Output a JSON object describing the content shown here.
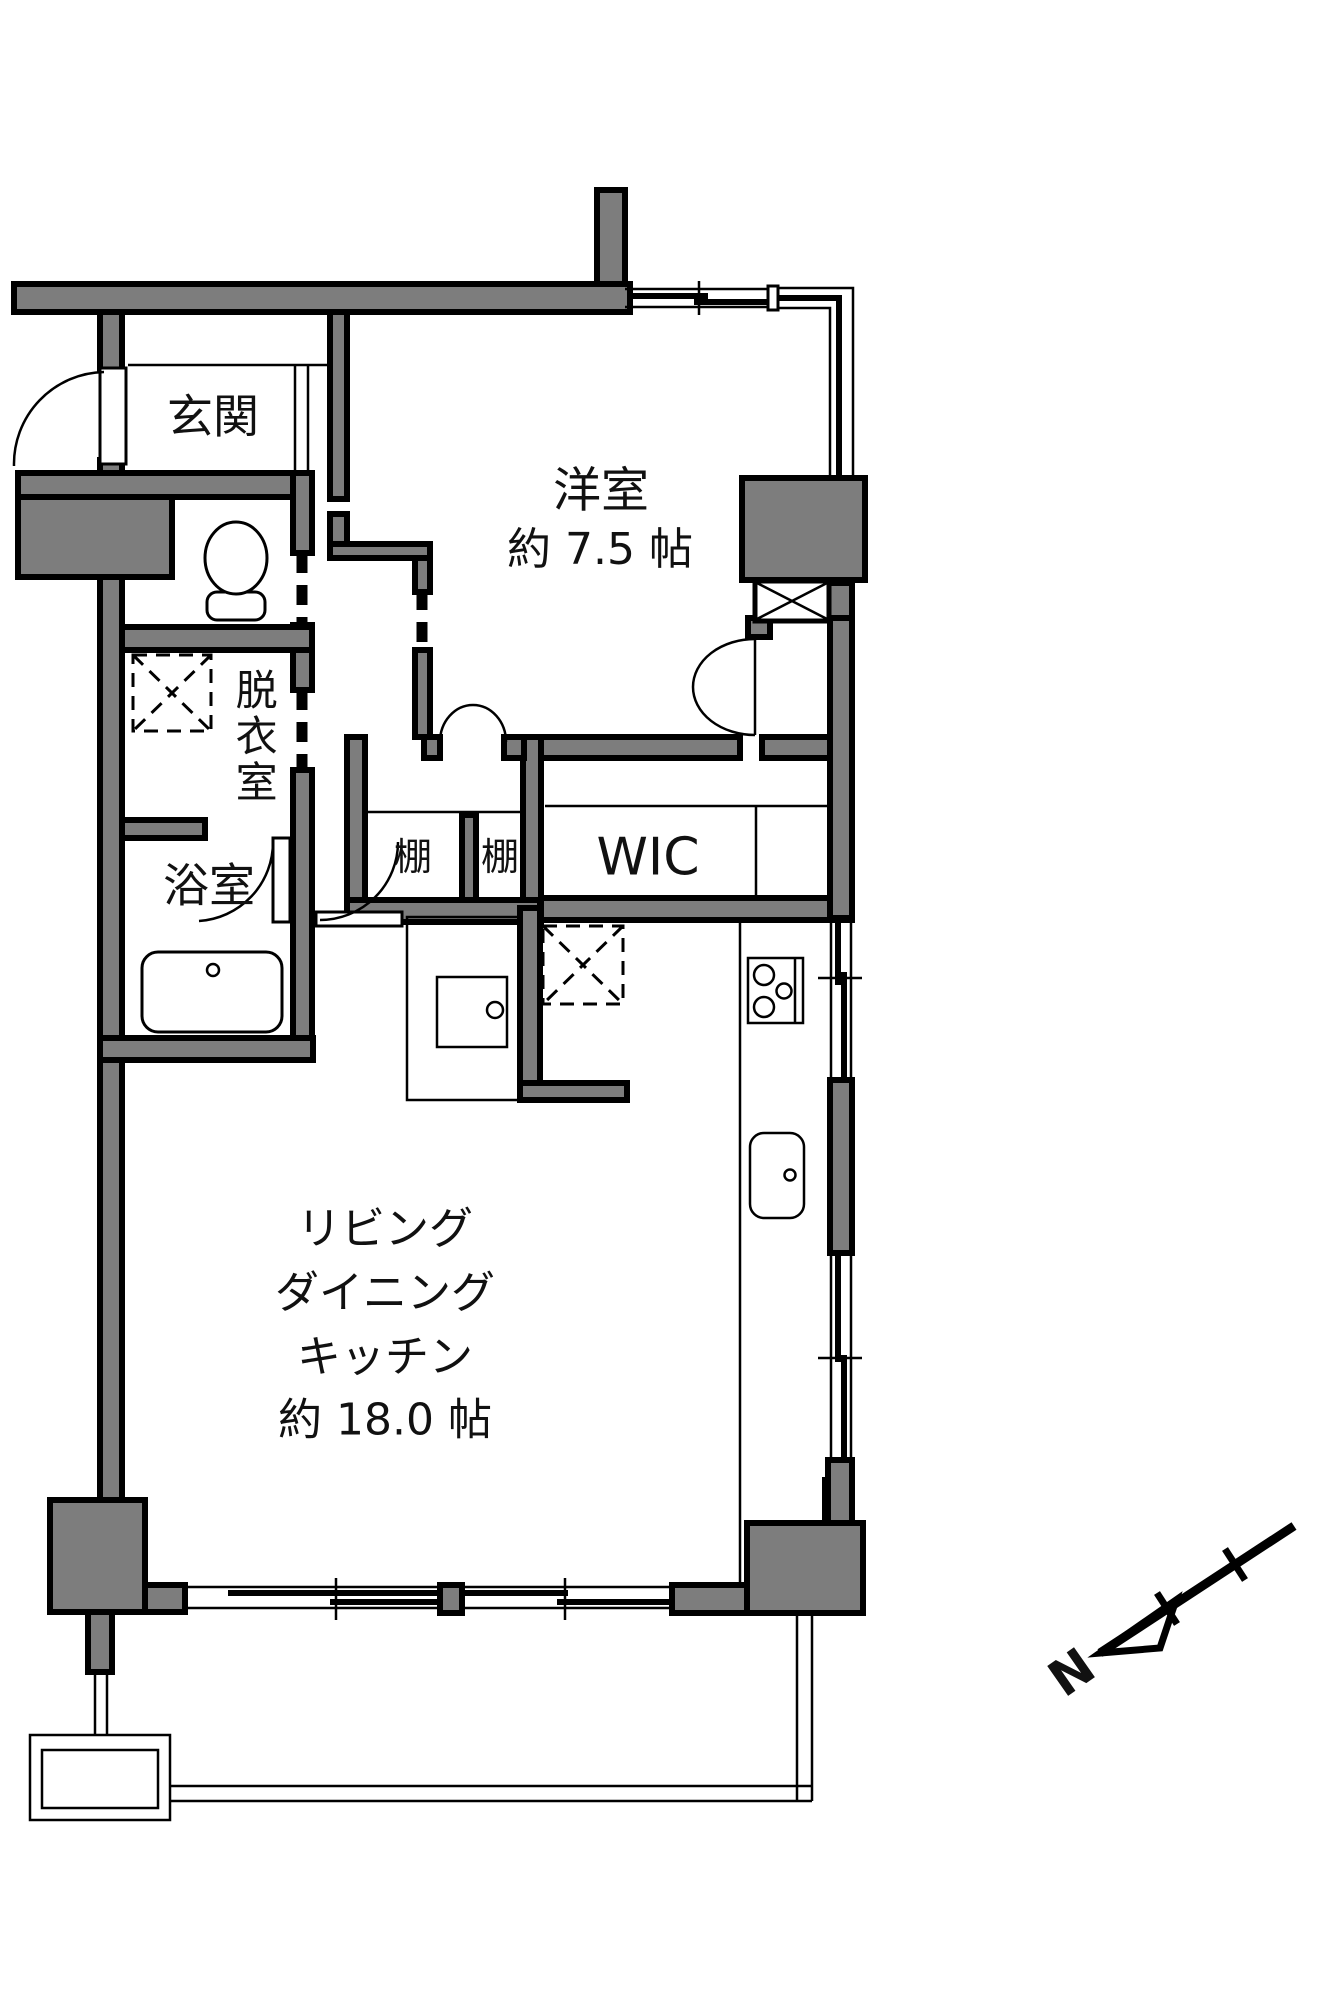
{
  "plan": {
    "rooms": {
      "entrance": {
        "label": "玄関"
      },
      "western_room": {
        "name": "洋室",
        "size": "約 7.5 帖"
      },
      "dressing_room": {
        "label": "脱衣室"
      },
      "bathroom": {
        "label": "浴室"
      },
      "shelf_left": {
        "label": "棚"
      },
      "shelf_right": {
        "label": "棚"
      },
      "walk_in_closet": {
        "label": "WIC"
      },
      "ldk": {
        "line1": "リビング",
        "line2": "ダイニング",
        "line3": "キッチン",
        "line4": "約 18.0 帖"
      }
    },
    "compass": {
      "north_label": "N"
    },
    "colors": {
      "wall_fill": "#7d7d7d",
      "outline": "#000000",
      "background": "#ffffff"
    }
  }
}
